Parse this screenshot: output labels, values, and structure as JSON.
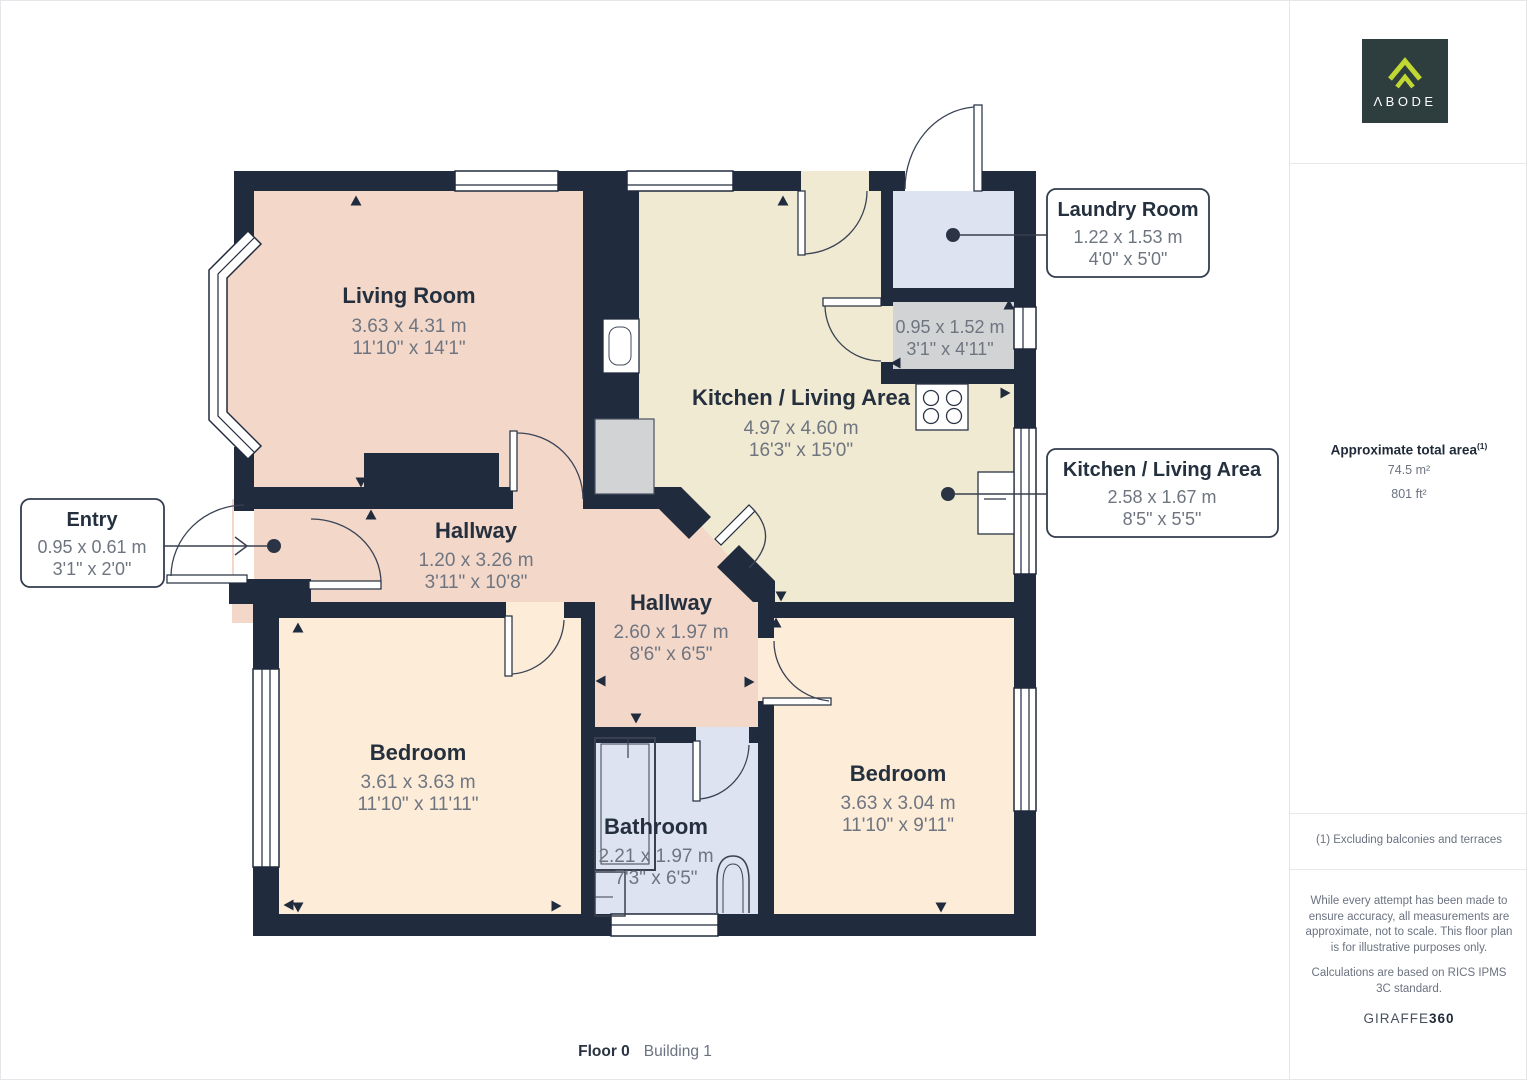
{
  "colors": {
    "wall": "#202b3d",
    "living_hall_fill": "#f3d8ca",
    "kitchen_fill": "#f1ead2",
    "bedroom_fill": "#fcecd8",
    "bath_laundry_fill": "#dde3f0",
    "closet_fill": "#d2d3d5",
    "logo_bg": "#2e3d3e",
    "logo_accent": "#c2d832",
    "dims_text": "#6f7580",
    "name_text": "#25303f"
  },
  "plan": {
    "rooms": [
      {
        "name": "Living Room",
        "metric": "3.63 x 4.31 m",
        "imperial": "11'10\" x 14'1\""
      },
      {
        "name": "Kitchen / Living Area",
        "metric": "4.97 x 4.60 m",
        "imperial": "16'3\" x 15'0\""
      },
      {
        "name": "Hallway",
        "metric": "1.20 x 3.26 m",
        "imperial": "3'11\" x 10'8\""
      },
      {
        "name": "Hallway",
        "metric": "2.60 x 1.97 m",
        "imperial": "8'6\" x 6'5\""
      },
      {
        "name": "Bedroom",
        "metric": "3.61 x 3.63 m",
        "imperial": "11'10\" x 11'11\""
      },
      {
        "name": "Bedroom",
        "metric": "3.63 x 3.04 m",
        "imperial": "11'10\" x 9'11\""
      },
      {
        "name": "Bathroom",
        "metric": "2.21 x 1.97 m",
        "imperial": "7'3\" x 6'5\""
      },
      {
        "name": "Closet",
        "metric": "0.95 x 1.52 m",
        "imperial": "3'1\" x 4'11\""
      }
    ],
    "callouts": [
      {
        "title": "Laundry Room",
        "metric": "1.22 x 1.53 m",
        "imperial": "4'0\" x 5'0\""
      },
      {
        "title": "Kitchen / Living Area",
        "metric": "2.58 x 1.67 m",
        "imperial": "8'5\" x 5'5\""
      },
      {
        "title": "Entry",
        "metric": "0.95 x 0.61 m",
        "imperial": "3'1\" x 2'0\""
      }
    ],
    "footer": {
      "floor": "Floor 0",
      "building": "Building 1"
    }
  },
  "sidebar": {
    "logo_text": "ΛBODE",
    "area": {
      "title": "Approximate total area",
      "sup": "(1)",
      "metric": "74.5 m²",
      "imperial": "801 ft²"
    },
    "note": "(1) Excluding balconies and terraces",
    "disclaimer_1": "While every attempt has been made to ensure accuracy, all measurements are approximate, not to scale. This floor plan is for illustrative purposes only.",
    "disclaimer_2": "Calculations are based on RICS IPMS 3C standard.",
    "brand_name": "GIRAFFE",
    "brand_suffix": "360"
  }
}
